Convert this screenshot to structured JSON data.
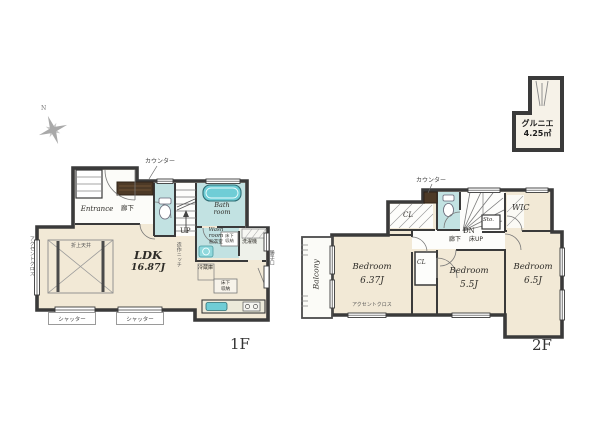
{
  "compass": {
    "north": "N"
  },
  "grenier": {
    "name": "グルニエ",
    "area": "4.25㎡"
  },
  "floor1": {
    "label": "1F",
    "counter": "カウンター",
    "entrance": "Entrance",
    "hallway": "廊下",
    "up": "UP",
    "bath_room": "Bath\nroom",
    "wash_room": "Wash\nroom",
    "wash_room_sub": "脱衣室",
    "underfloor_storage_wash": "床下\n収納",
    "washer": "洗濯機",
    "fridge": "冷蔵庫",
    "underfloor_storage_kitchen": "床下\n収納",
    "ldk_name": "LDK",
    "ldk_area": "16.87J",
    "coffered_ceiling": "折上天井",
    "accent_wall": "アクセントクロス",
    "niche": "造作ニッチ",
    "back_door": "勝手口",
    "shutter": "シャッター"
  },
  "floor2": {
    "label": "2F",
    "counter": "カウンター",
    "closet_main": "CL",
    "closet_bedroom2": "CL",
    "down": "DN",
    "hallway": "廊下",
    "floor_up": "床UP",
    "storage": "Sto.",
    "wic": "WIC",
    "balcony": "Balcony",
    "accent_wall": "アクセントクロス",
    "bedroom1": {
      "name": "Bedroom",
      "area": "6.37J"
    },
    "bedroom2": {
      "name": "Bedroom",
      "area": "5.5J"
    },
    "bedroom3": {
      "name": "Bedroom",
      "area": "6.5J"
    }
  }
}
